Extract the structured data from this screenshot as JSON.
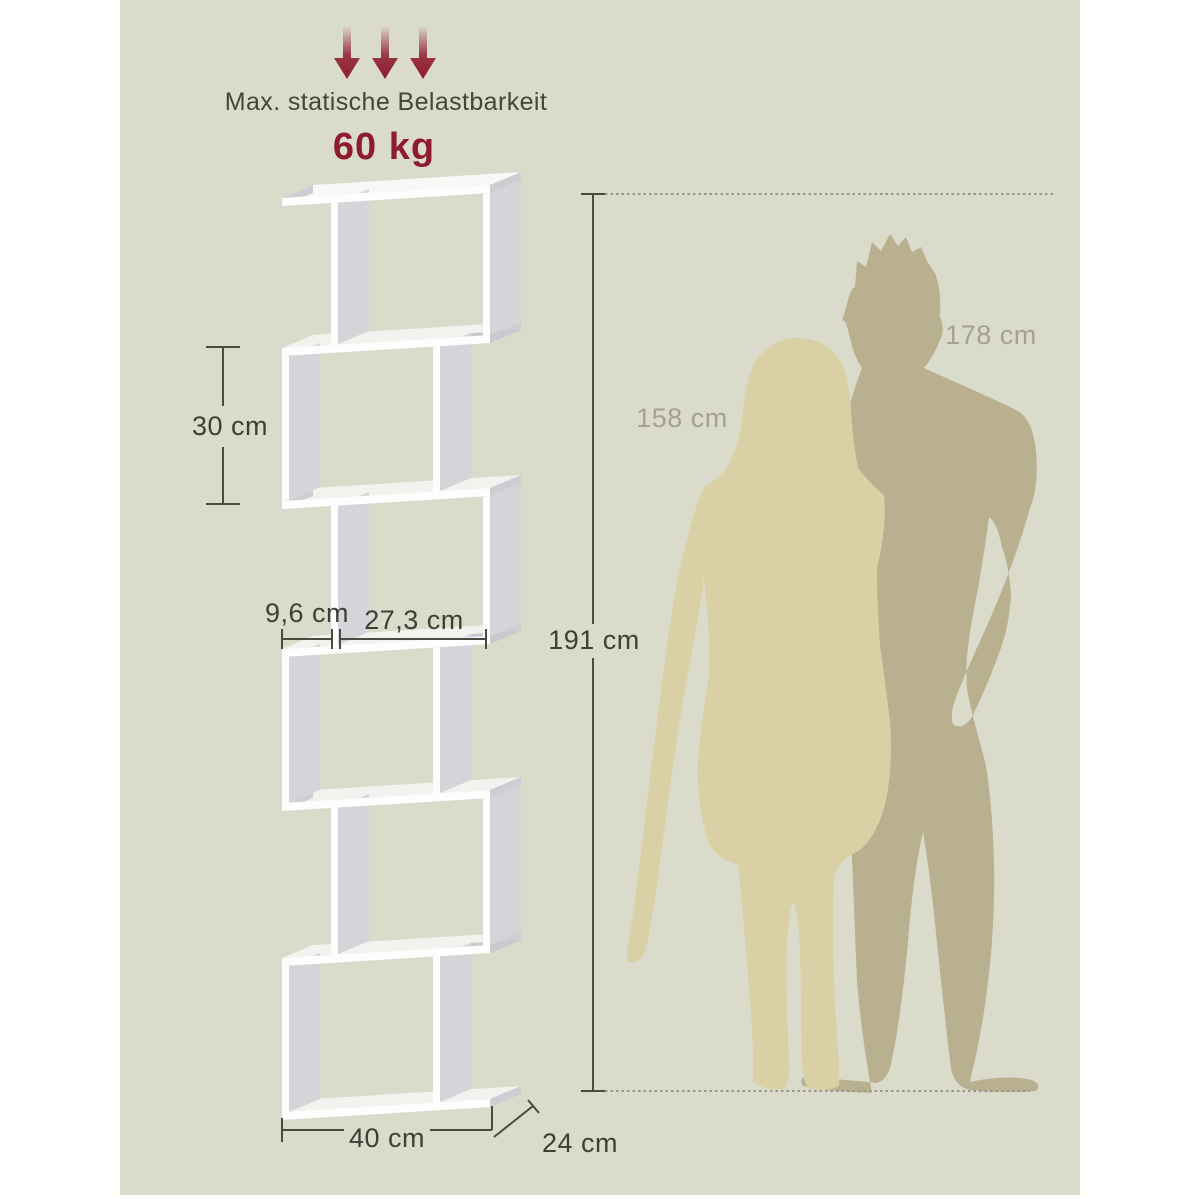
{
  "title": "Bookshelf dimension infographic",
  "load": {
    "label": "Max. statische Belastbarkeit",
    "value": "60 kg"
  },
  "dims": {
    "cell_height": "30 cm",
    "inner_small": "9,6 cm",
    "inner_large": "27,3 cm",
    "total_height": "191 cm",
    "total_width": "40 cm",
    "total_depth": "24 cm"
  },
  "people": {
    "woman_height": "158 cm",
    "man_height": "178 cm"
  },
  "icons": {
    "load_arrows": "three-down-arrows-icon"
  },
  "colors": {
    "background_panel": "#dadbca",
    "page_margin": "#ffffff",
    "shelf_front": "#fdfdfd",
    "shelf_top_face": "#f2f2ef",
    "shelf_inner_panel": "#d4d5d9",
    "shelf_edge_grain": "#cdced3",
    "dimension_line": "#4a4a40",
    "dotted_line": "#98968a",
    "accent_red": "#8e1b2e",
    "text_dark": "#3f3f37",
    "person_label": "#a5a18f",
    "woman_silhouette": "#d9d0a6",
    "man_silhouette": "#b9b08f"
  }
}
